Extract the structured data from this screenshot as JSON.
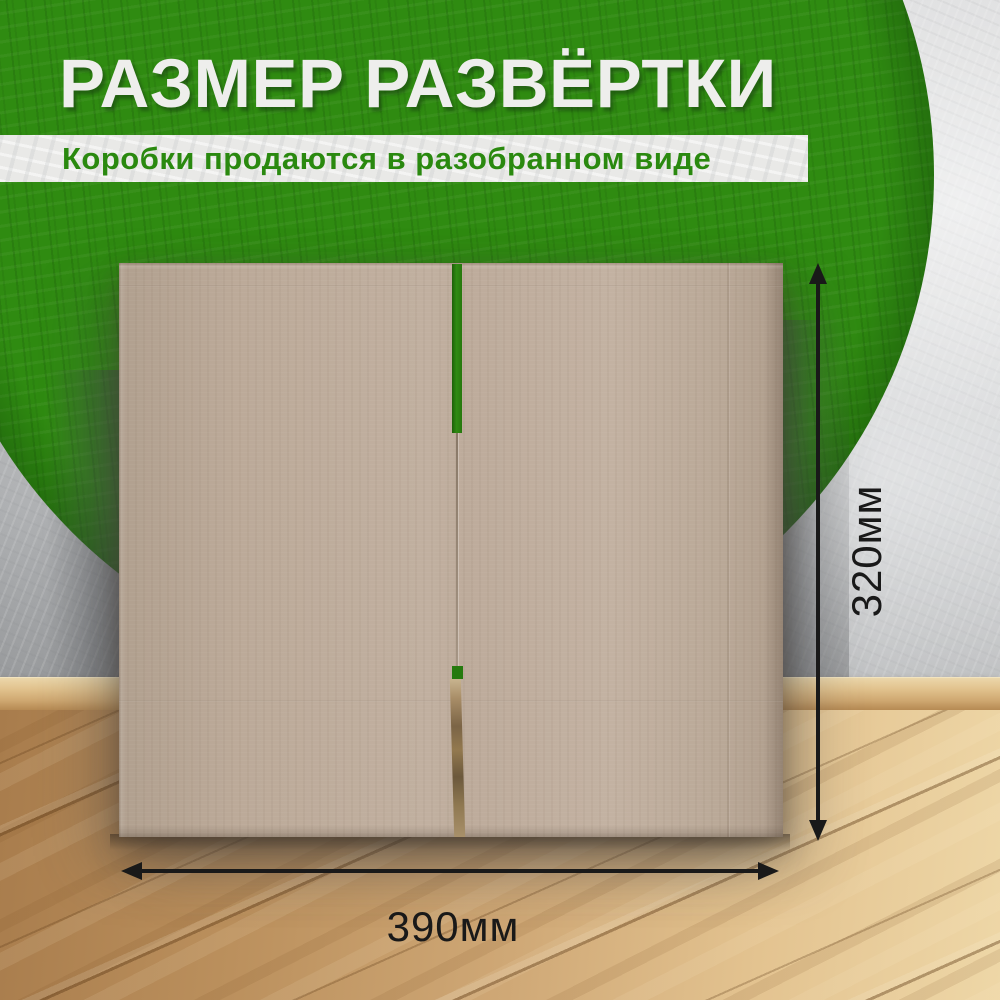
{
  "banner": {
    "title": "РАЗМЕР РАЗВЁРТКИ",
    "subtitle": "Коробки продаются в разобранном виде"
  },
  "dimensions": {
    "height_label": "320мм",
    "width_label": "390мм"
  },
  "colors": {
    "accent_green": "#2f8b11",
    "title_text": "#eeeeec",
    "subtitle_text": "#2a890f",
    "subtitle_strip_bg": "#e9e9e7",
    "arrow_black": "#191919",
    "cardboard": "#bdab9b",
    "wall_gray": "#d2d3d4",
    "floor_wood": "#cfa876"
  }
}
